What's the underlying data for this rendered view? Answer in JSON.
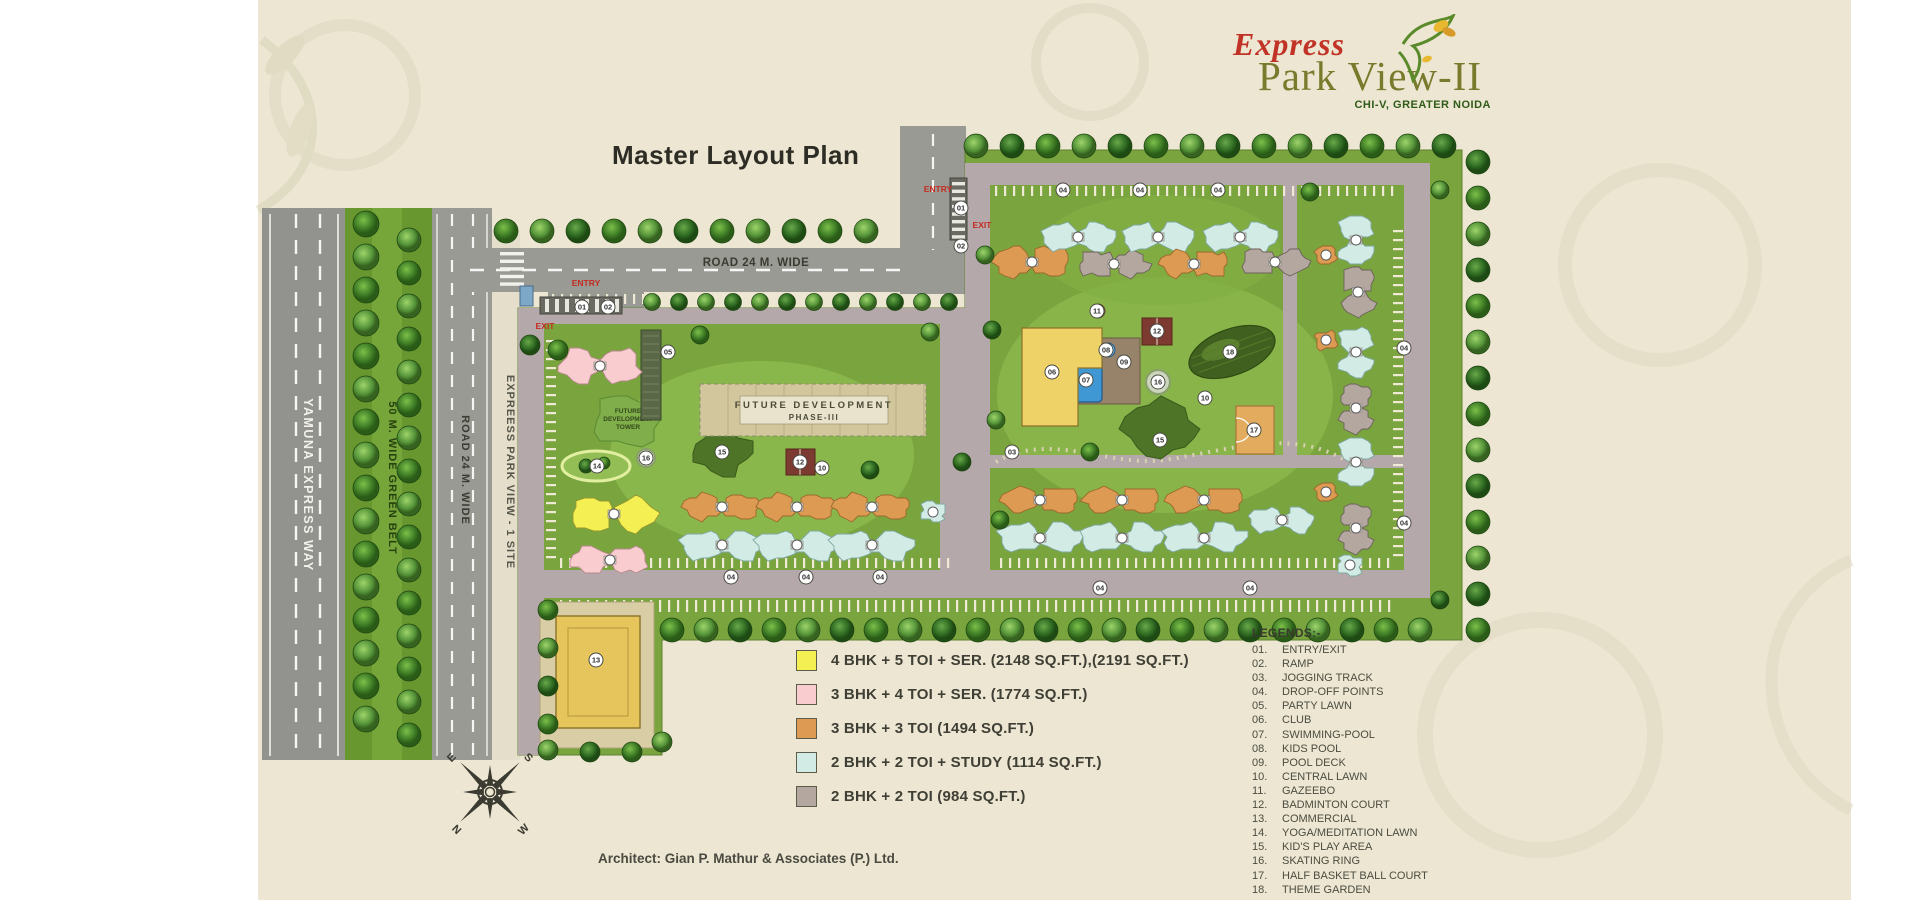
{
  "branding": {
    "line1": "Express",
    "line2": "Park View-II",
    "location": "CHI-V, GREATER NOIDA"
  },
  "title": "Master Layout Plan",
  "architect": "Architect: Gian P. Mathur & Associates (P.) Ltd.",
  "roads": {
    "yamuna": "YAMUNA EXPRESS WAY",
    "green_belt": "50 M. WIDE GREEN BELT",
    "road24_left": "ROAD 24 M. WIDE",
    "adjacent_site": "EXPREESS PARK VIEW - 1 SITE",
    "road24_top": "ROAD 24 M. WIDE"
  },
  "site_labels": {
    "future_dev_line1": "FUTURE DEVELOPMENT",
    "future_dev_line2": "PHASE-III",
    "future_tower": [
      "FUTURE",
      "DEVELOPMENT",
      "TOWER"
    ],
    "entry": "ENTRY",
    "exit": "EXIT"
  },
  "compass_points": {
    "top_left": "E",
    "top_right": "S",
    "bottom_left": "N",
    "bottom_right": "W"
  },
  "unit_legend": [
    {
      "label": "4 BHK + 5 TOI + SER. (2148 SQ.FT.),(2191 SQ.FT.)",
      "color": "#f4f054",
      "border": "#97972e",
      "hatch": false
    },
    {
      "label": "3 BHK + 4 TOI + SER. (1774 SQ.FT.)",
      "color": "#f9cccf",
      "border": "#b8898d",
      "hatch": false
    },
    {
      "label": "3 BHK + 3 TOI (1494 SQ.FT.)",
      "color": "#dc9a52",
      "border": "#9c682c",
      "hatch": false
    },
    {
      "label": "2 BHK + 2 TOI + STUDY (1114 SQ.FT.)",
      "color": "#d2ebe5",
      "border": "#7fa8a0",
      "hatch": false
    },
    {
      "label": "2 BHK + 2 TOI (984 SQ.FT.)",
      "color": "#b4a7a0",
      "border": "#6e625c",
      "hatch": true
    }
  ],
  "legends": {
    "heading": "LEGENDS:-",
    "items": [
      {
        "no": "01.",
        "label": "ENTRY/EXIT"
      },
      {
        "no": "02.",
        "label": "RAMP"
      },
      {
        "no": "03.",
        "label": "JOGGING TRACK"
      },
      {
        "no": "04.",
        "label": "DROP-OFF POINTS"
      },
      {
        "no": "05.",
        "label": "PARTY LAWN"
      },
      {
        "no": "06.",
        "label": "CLUB"
      },
      {
        "no": "07.",
        "label": "SWIMMING-POOL"
      },
      {
        "no": "08.",
        "label": "KIDS POOL"
      },
      {
        "no": "09.",
        "label": "POOL DECK"
      },
      {
        "no": "10.",
        "label": "CENTRAL LAWN"
      },
      {
        "no": "11.",
        "label": "GAZEEBO"
      },
      {
        "no": "12.",
        "label": "BADMINTON COURT"
      },
      {
        "no": "13.",
        "label": "COMMERCIAL"
      },
      {
        "no": "14.",
        "label": "YOGA/MEDITATION LAWN"
      },
      {
        "no": "15.",
        "label": "KID'S PLAY AREA"
      },
      {
        "no": "16.",
        "label": "SKATING RING"
      },
      {
        "no": "17.",
        "label": "HALF BASKET BALL COURT"
      },
      {
        "no": "18.",
        "label": "THEME GARDEN"
      }
    ]
  },
  "plan_markers": [
    {
      "no": "01",
      "x": 961,
      "y": 208
    },
    {
      "no": "02",
      "x": 961,
      "y": 246
    },
    {
      "no": "01",
      "x": 582,
      "y": 307
    },
    {
      "no": "02",
      "x": 608,
      "y": 307
    },
    {
      "no": "03",
      "x": 1012,
      "y": 452
    },
    {
      "no": "04",
      "x": 731,
      "y": 577
    },
    {
      "no": "04",
      "x": 806,
      "y": 577
    },
    {
      "no": "04",
      "x": 880,
      "y": 577
    },
    {
      "no": "04",
      "x": 1063,
      "y": 190
    },
    {
      "no": "04",
      "x": 1140,
      "y": 190
    },
    {
      "no": "04",
      "x": 1218,
      "y": 190
    },
    {
      "no": "04",
      "x": 1404,
      "y": 348
    },
    {
      "no": "04",
      "x": 1404,
      "y": 523
    },
    {
      "no": "04",
      "x": 1100,
      "y": 588
    },
    {
      "no": "04",
      "x": 1250,
      "y": 588
    },
    {
      "no": "05",
      "x": 668,
      "y": 352
    },
    {
      "no": "06",
      "x": 1052,
      "y": 372
    },
    {
      "no": "07",
      "x": 1086,
      "y": 380
    },
    {
      "no": "08",
      "x": 1106,
      "y": 350
    },
    {
      "no": "09",
      "x": 1124,
      "y": 362
    },
    {
      "no": "10",
      "x": 1205,
      "y": 398
    },
    {
      "no": "10",
      "x": 822,
      "y": 468
    },
    {
      "no": "11",
      "x": 1097,
      "y": 311
    },
    {
      "no": "12",
      "x": 1157,
      "y": 331
    },
    {
      "no": "12",
      "x": 800,
      "y": 462
    },
    {
      "no": "13",
      "x": 596,
      "y": 660
    },
    {
      "no": "14",
      "x": 597,
      "y": 466
    },
    {
      "no": "15",
      "x": 722,
      "y": 452
    },
    {
      "no": "15",
      "x": 1160,
      "y": 440
    },
    {
      "no": "16",
      "x": 646,
      "y": 458
    },
    {
      "no": "16",
      "x": 1158,
      "y": 382
    },
    {
      "no": "17",
      "x": 1254,
      "y": 430
    },
    {
      "no": "18",
      "x": 1230,
      "y": 352
    }
  ]
}
